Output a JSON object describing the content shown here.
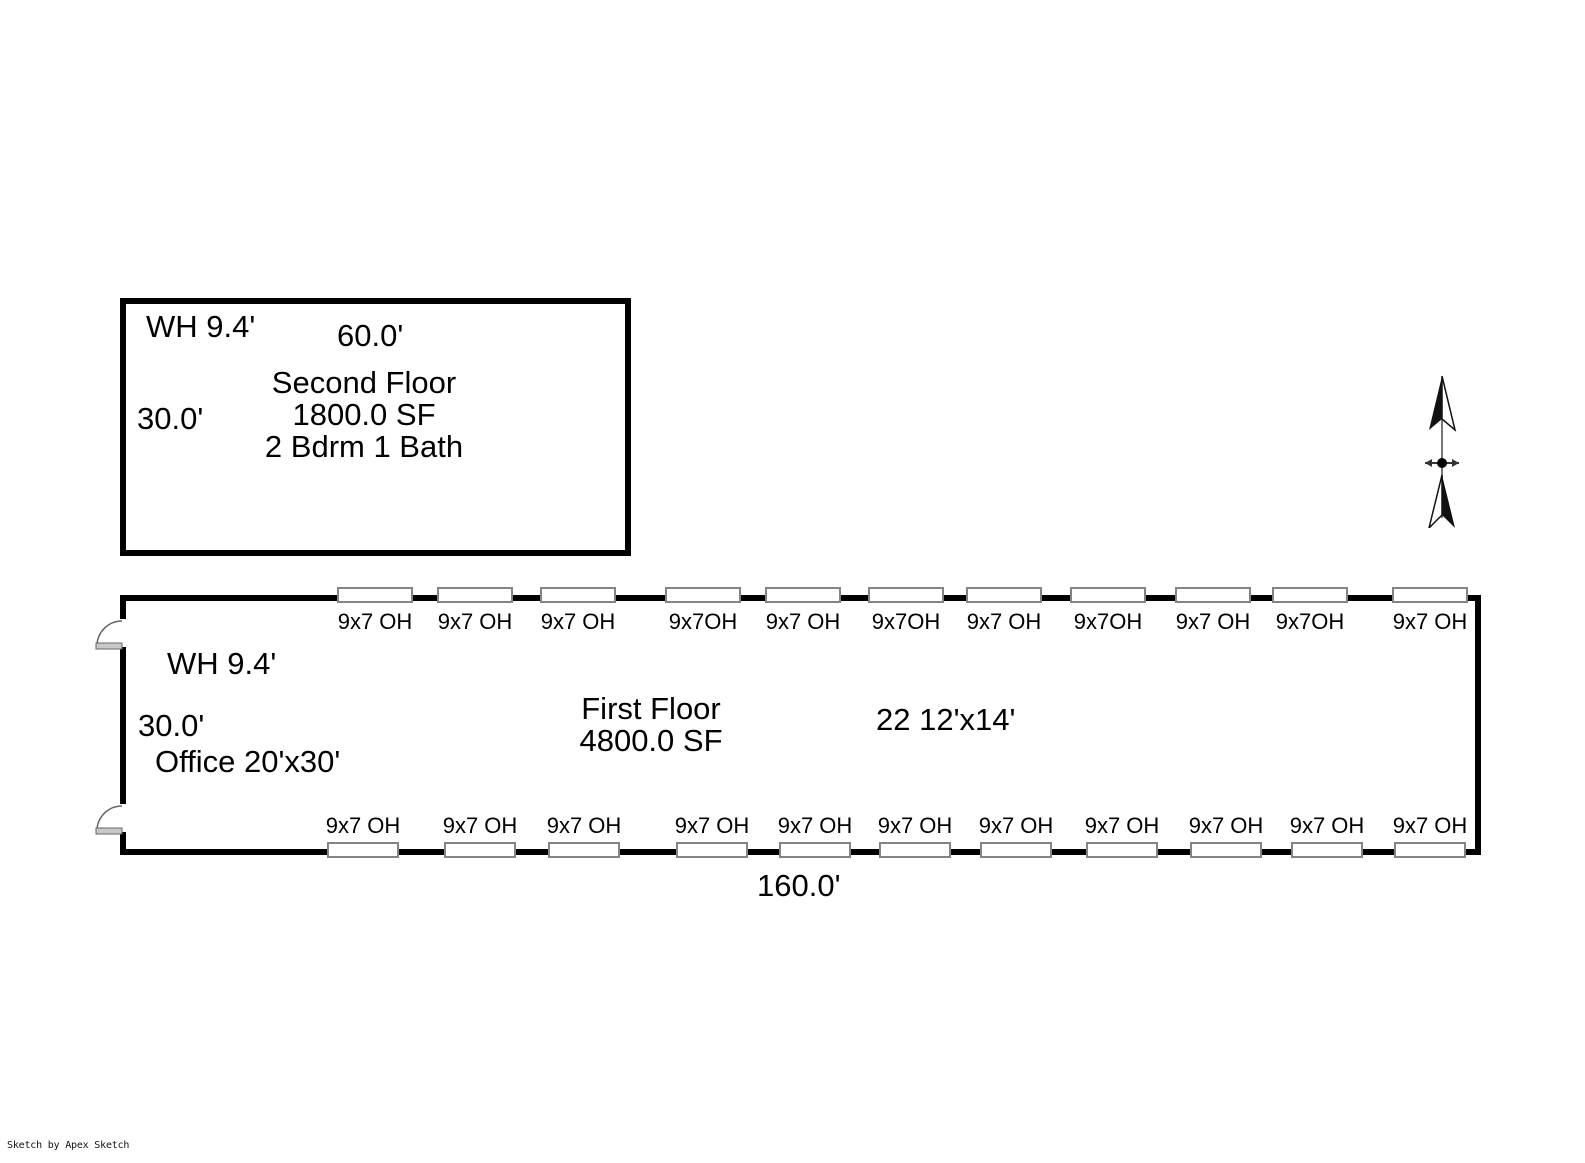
{
  "credit": "Sketch by Apex Sketch",
  "second_floor": {
    "wall_height_label": "WH 9.4'",
    "width_label": "60.0'",
    "height_label": "30.0'",
    "name": "Second Floor",
    "area": "1800.0 SF",
    "rooms": "2 Bdrm 1 Bath"
  },
  "first_floor": {
    "wall_height_label": "WH 9.4'",
    "height_label": "30.0'",
    "office_label": "Office 20'x30'",
    "name": "First Floor",
    "area": "4800.0 SF",
    "units_label": "22 12'x14'",
    "width_label": "160.0'",
    "top_doors": [
      "9x7 OH",
      "9x7 OH",
      "9x7 OH",
      "9x7OH",
      "9x7 OH",
      "9x7OH",
      "9x7 OH",
      "9x7OH",
      "9x7 OH",
      "9x7OH",
      "9x7 OH"
    ],
    "bottom_doors": [
      "9x7 OH",
      "9x7 OH",
      "9x7 OH",
      "9x7 OH",
      "9x7 OH",
      "9x7 OH",
      "9x7 OH",
      "9x7 OH",
      "9x7 OH",
      "9x7 OH",
      "9x7 OH"
    ]
  },
  "compass": {
    "label": "north-arrow"
  }
}
